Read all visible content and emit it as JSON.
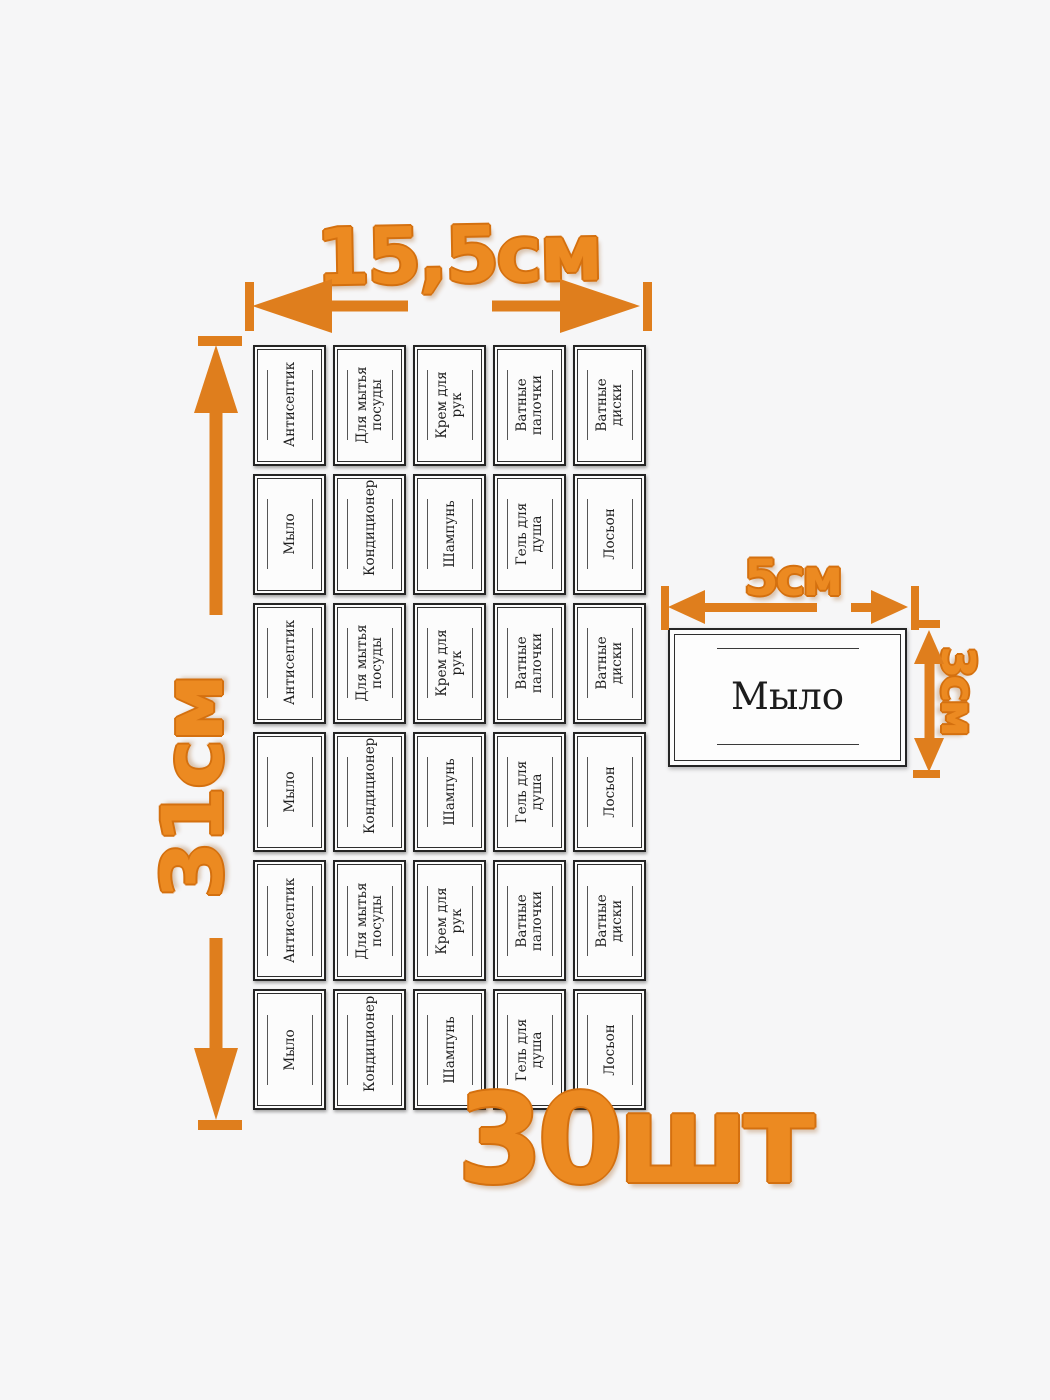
{
  "dimensions": {
    "sheet_width": "15,5см",
    "sheet_height": "31см",
    "label_width": "5см",
    "label_height": "3см",
    "count": "30шт"
  },
  "sheet": {
    "rows": [
      [
        "Антисептик",
        "Для мытья посуды",
        "Крем для рук",
        "Ватные палочки",
        "Ватные диски"
      ],
      [
        "Мыло",
        "Кондиционер",
        "Шампунь",
        "Гель для душа",
        "Лосьон"
      ],
      [
        "Антисептик",
        "Для мытья посуды",
        "Крем для рук",
        "Ватные палочки",
        "Ватные диски"
      ],
      [
        "Мыло",
        "Кондиционер",
        "Шампунь",
        "Гель для душа",
        "Лосьон"
      ],
      [
        "Антисептик",
        "Для мытья посуды",
        "Крем для рук",
        "Ватные палочки",
        "Ватные диски"
      ],
      [
        "Мыло",
        "Кондиционер",
        "Шампунь",
        "Гель для душа",
        "Лосьон"
      ]
    ]
  },
  "sample_label": {
    "text": "Мыло"
  },
  "colors": {
    "accent": "#ec8a21",
    "accent_outline": "#d4700f",
    "background": "#f6f6f7",
    "label_background": "#fcfcfc",
    "label_border": "#242424"
  }
}
